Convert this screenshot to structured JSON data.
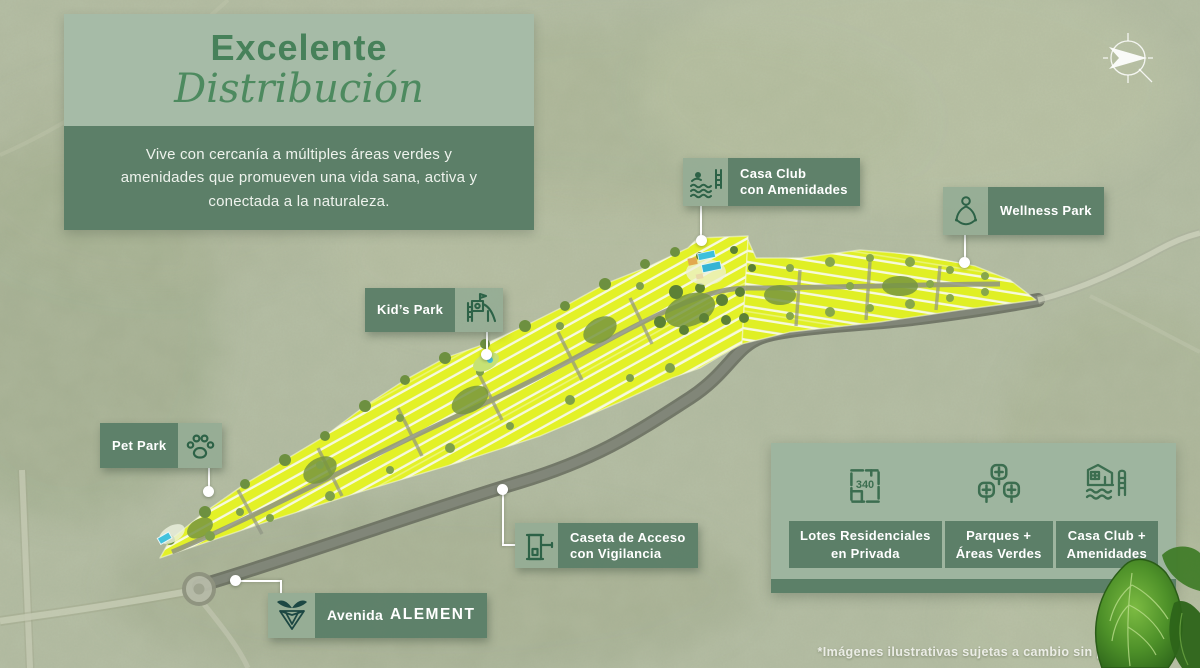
{
  "header": {
    "title_line1": "Excelente",
    "title_line2": "Distribución",
    "description": "Vive con cercanía a múltiples áreas verdes y amenidades que promueven una vida sana, activa y conectada a la naturaleza."
  },
  "map_labels": {
    "casa_club": {
      "line1": "Casa Club",
      "line2": "con Amenidades",
      "icon": "pool-swimmer-icon"
    },
    "wellness_park": {
      "label": "Wellness Park",
      "icon": "meditation-icon"
    },
    "kids_park": {
      "label": "Kid’s Park",
      "icon": "playground-slide-icon"
    },
    "pet_park": {
      "label": "Pet Park",
      "icon": "paw-icon"
    },
    "caseta": {
      "line1": "Caseta de Acceso",
      "line2": "con Vigilancia",
      "icon": "guard-booth-icon"
    },
    "avenida": {
      "prefix": "Avenida",
      "name": "ALEMENT",
      "icon": "alement-logo-icon"
    }
  },
  "legend": {
    "items": [
      {
        "icon": "lot-plan-icon",
        "lot_size": "340",
        "line1": "Lotes Residenciales",
        "line2": "en Privada"
      },
      {
        "icon": "trees-icon",
        "line1": "Parques +",
        "line2": "Áreas Verdes"
      },
      {
        "icon": "clubhouse-pool-icon",
        "line1": "Casa Club +",
        "line2": "Amenidades"
      }
    ]
  },
  "footer": {
    "disclaimer": "*Imágenes ilustrativas sujetas a cambio sin previo aviso."
  },
  "colors": {
    "accent_green": "#47815a",
    "panel_light": "#a6bba7",
    "panel_dark": "#5c7f68",
    "label_icon_bg": "#94ac95",
    "lot_yellow": "#e3f127",
    "road_gray": "#82877a"
  }
}
